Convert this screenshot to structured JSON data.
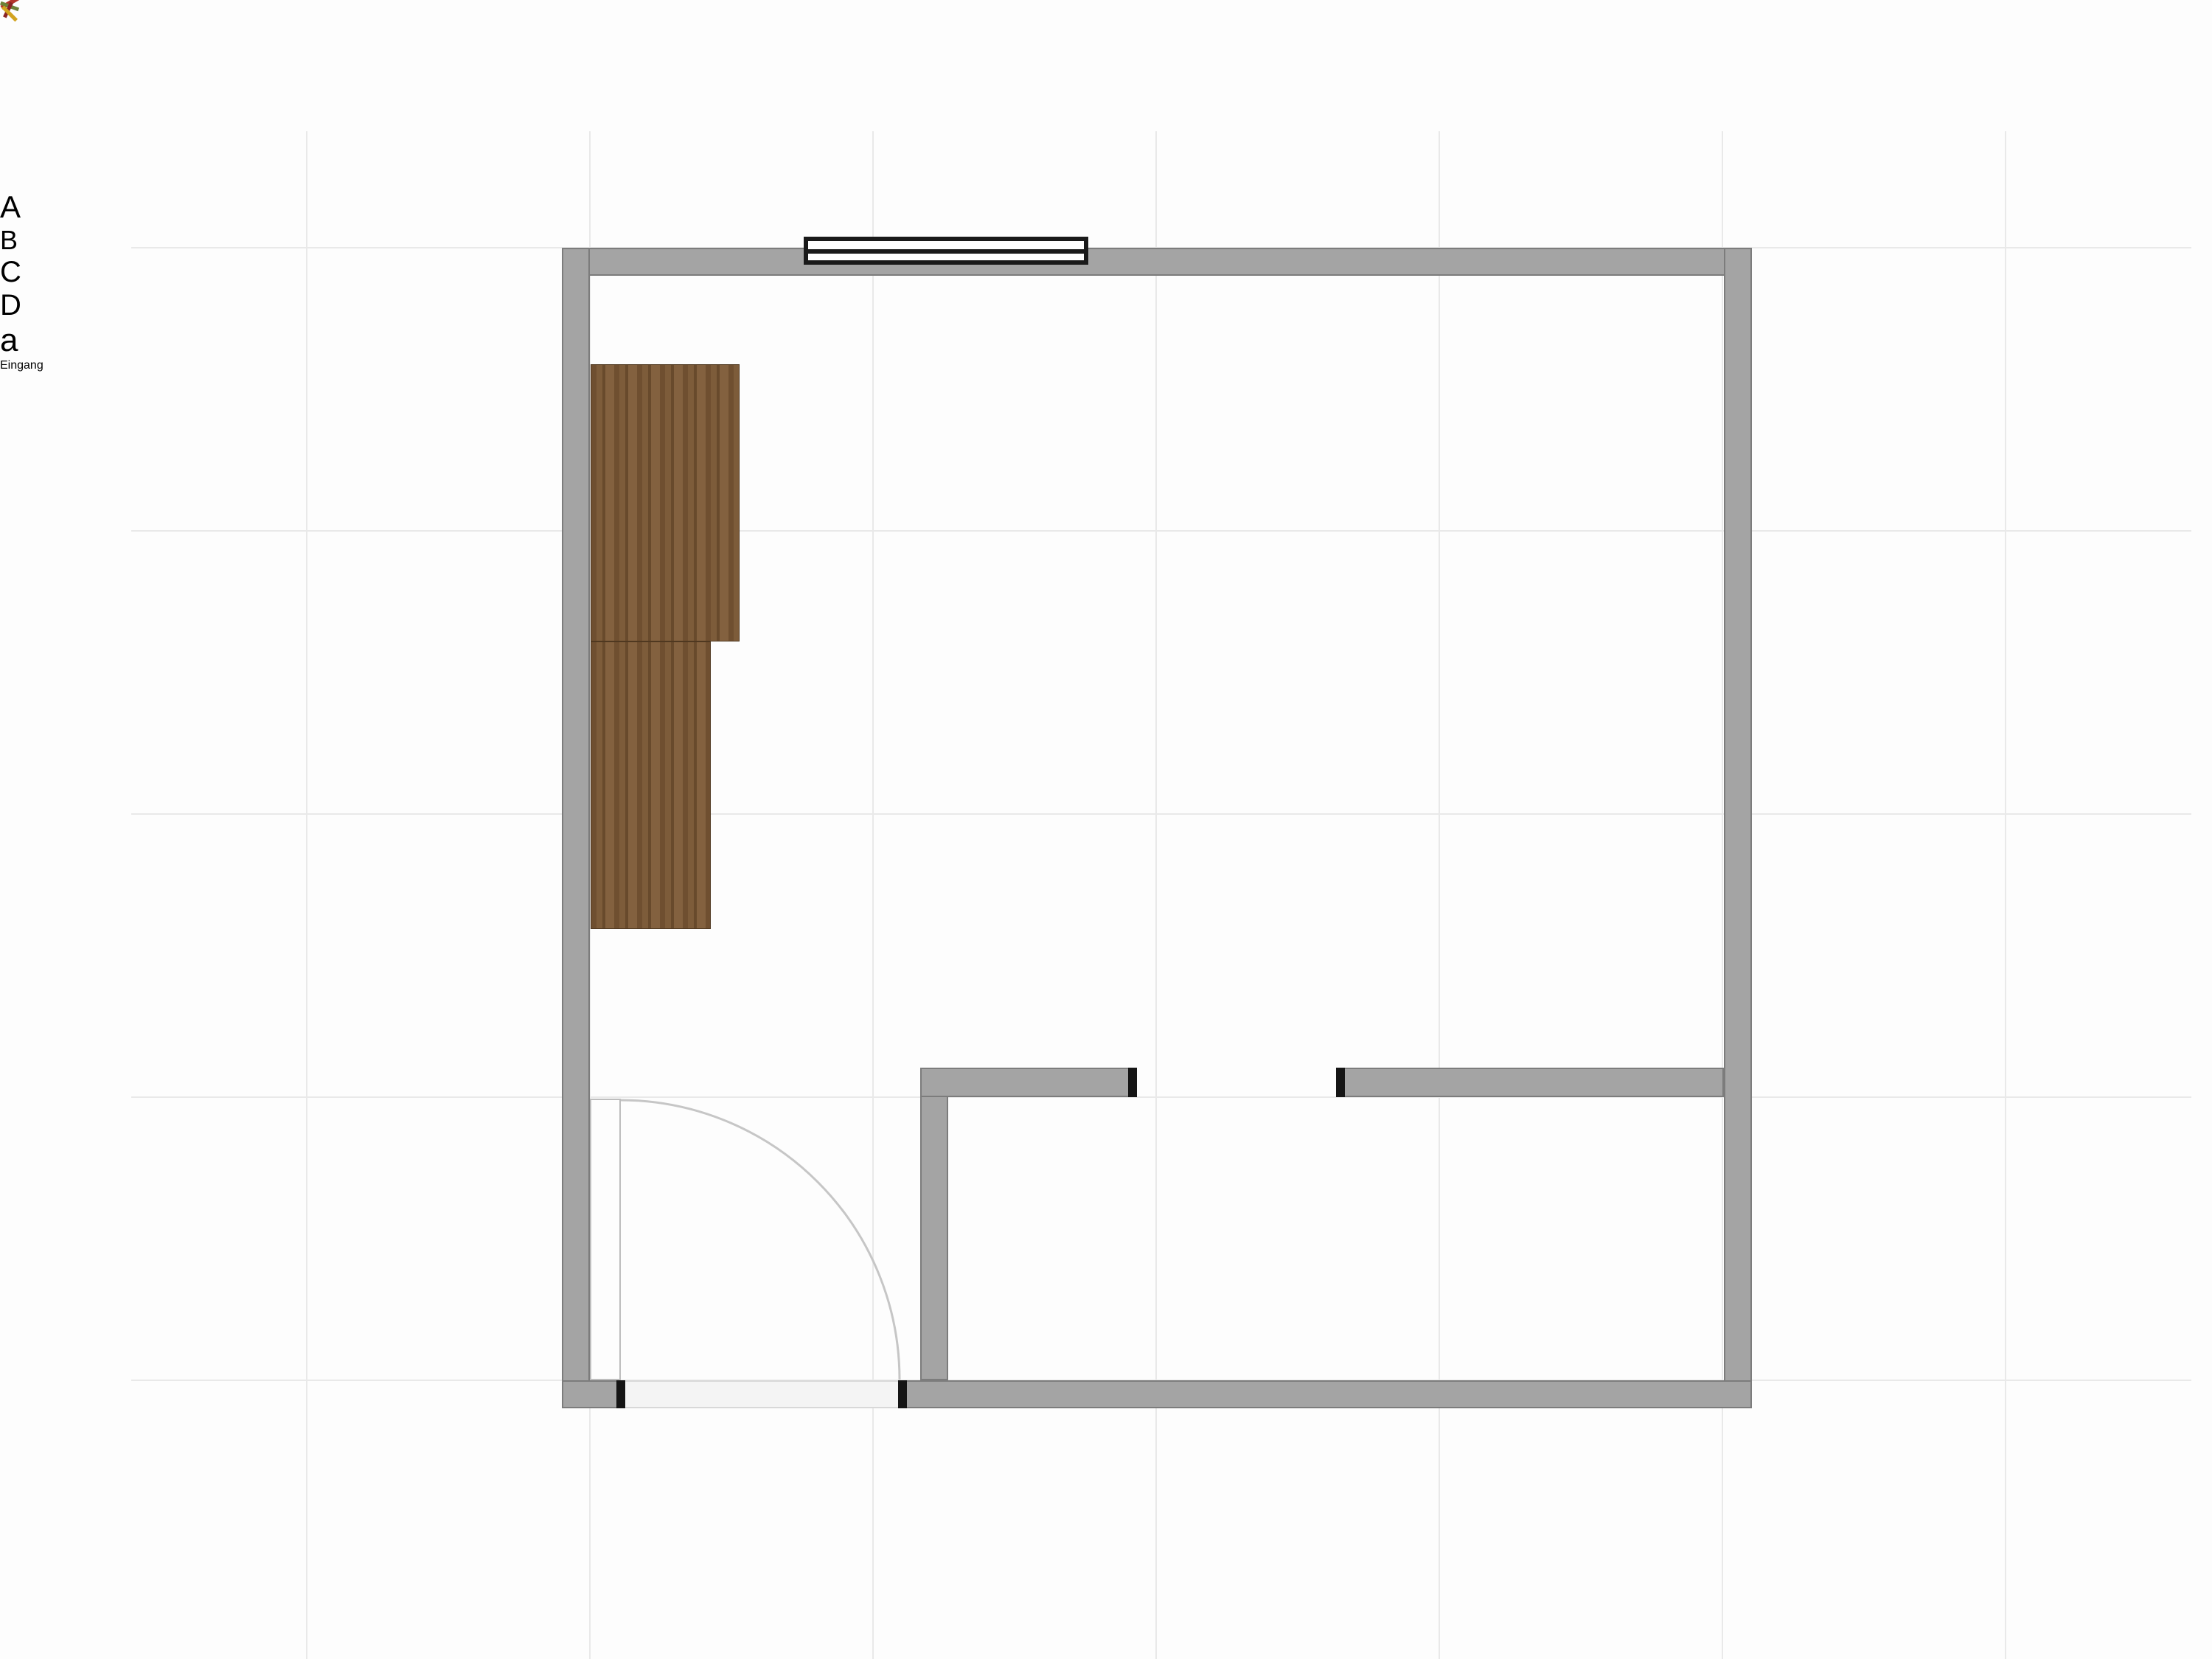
{
  "plan": {
    "entrance_label": "Eingang",
    "wall_labels": {
      "left": "A",
      "top": "B",
      "right": "C",
      "bottom": "D",
      "bathroom_partition": "a"
    },
    "colors": {
      "wall": "#a4a4a4",
      "wall-edge": "#7c7c7c",
      "grid": "#e9e9e9",
      "bg": "#fdfdfd",
      "wood": "#7a5939",
      "bed-linen": "#eae6cf",
      "bed-frame": "#4a3520",
      "chair": "#e2e1c4",
      "yellow": "#eec31d",
      "shower-head": "#8a9180",
      "label": "#f5f5f5",
      "text": "#141414"
    }
  }
}
